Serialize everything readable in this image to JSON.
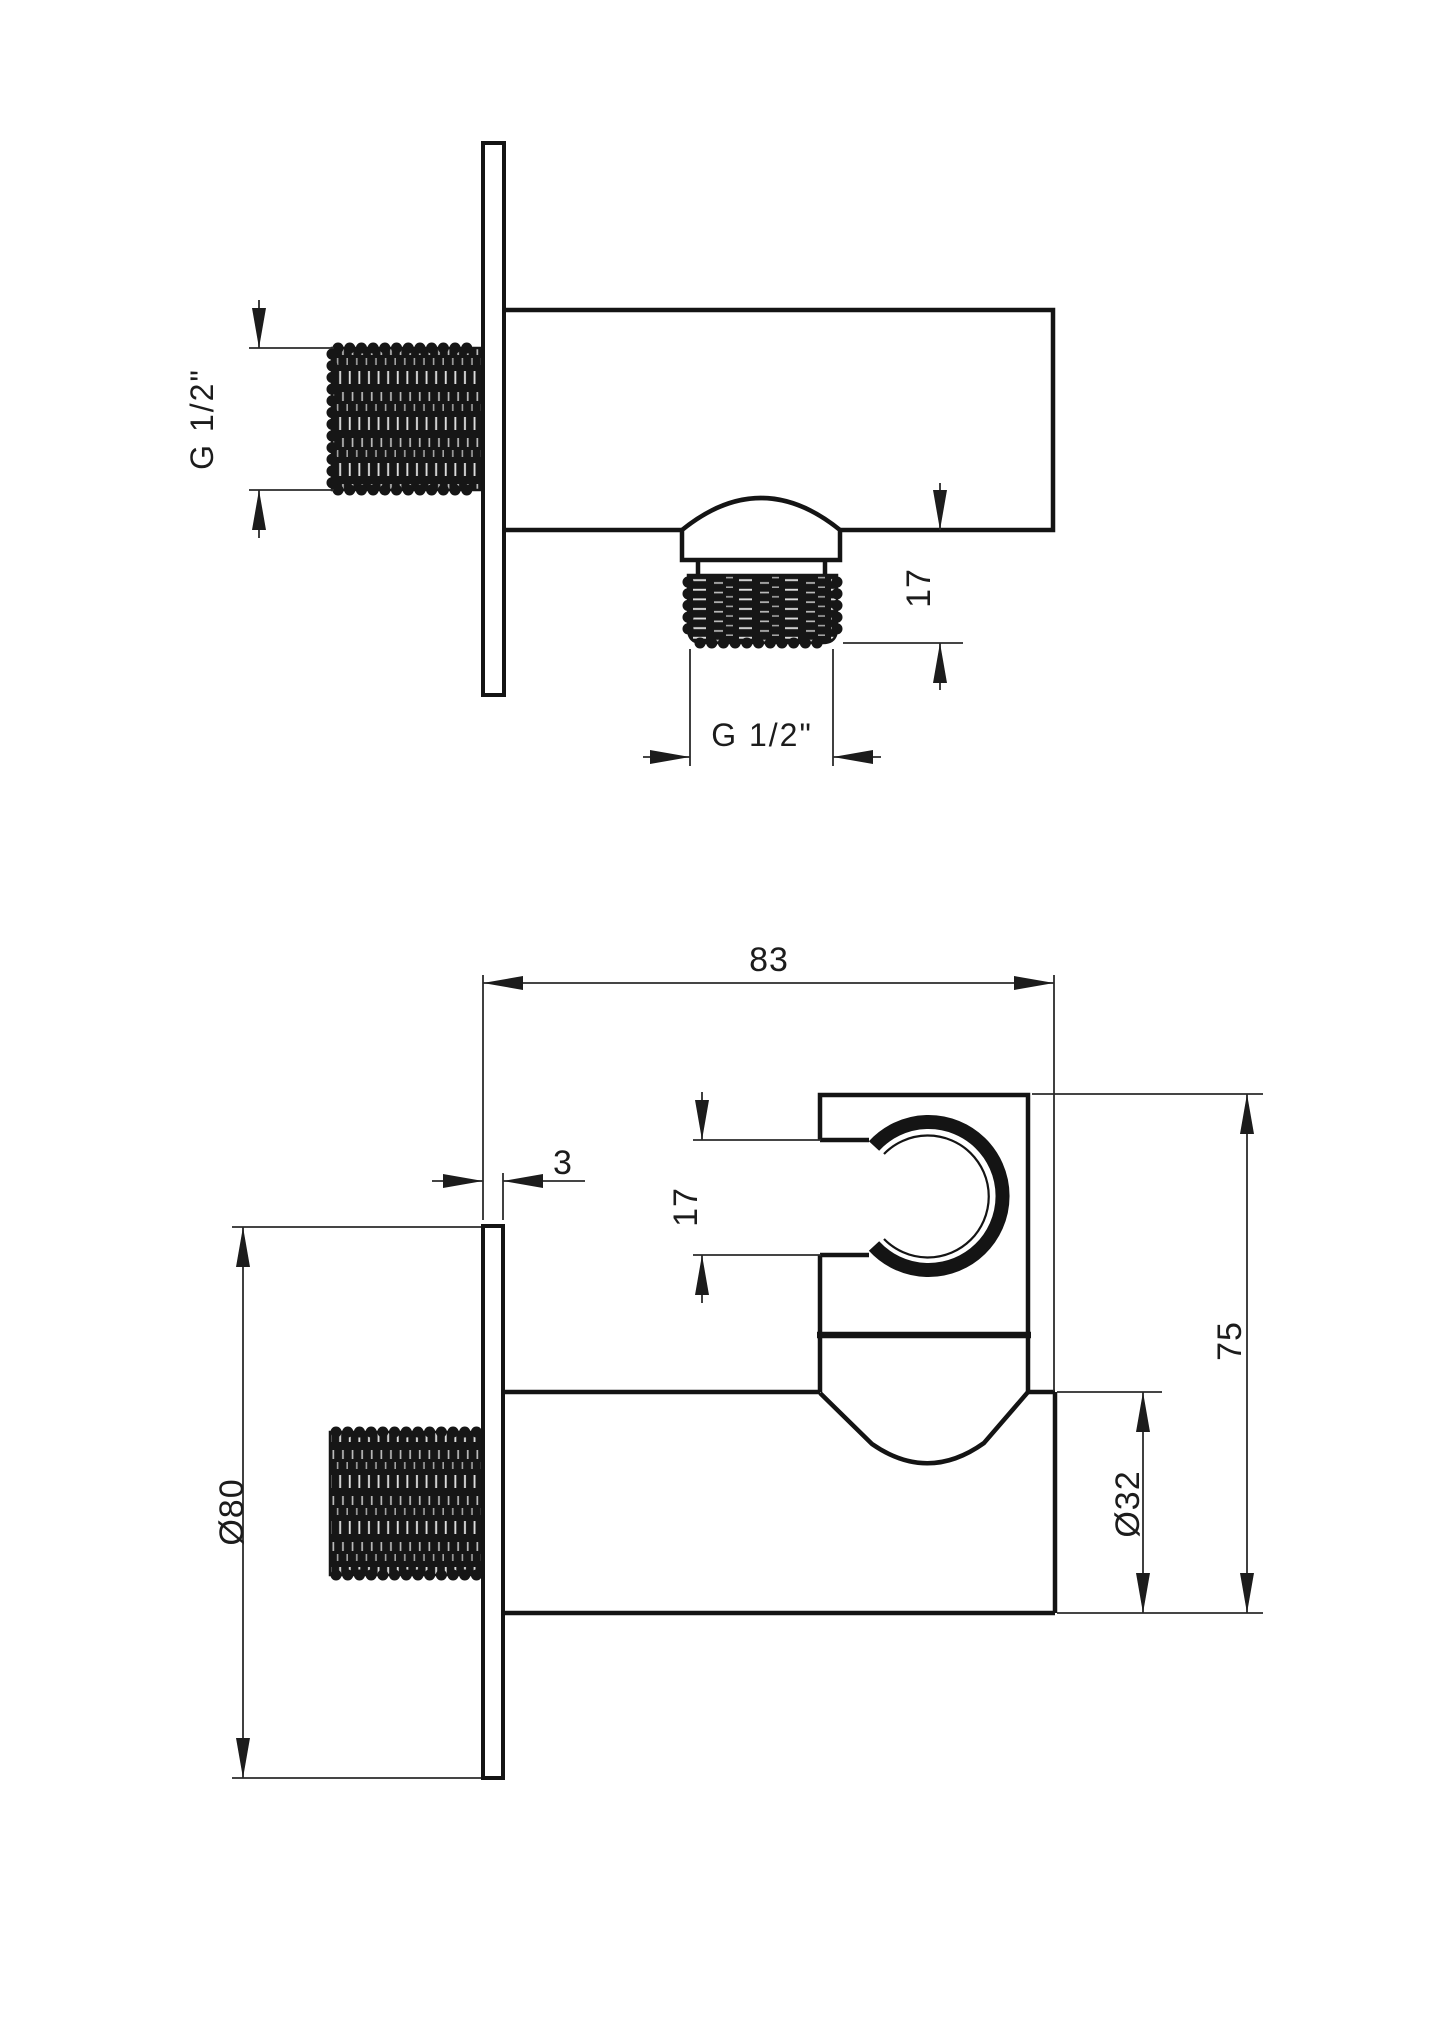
{
  "drawing": {
    "type": "technical-drawing",
    "subject": "wall shower elbow outlet with hand-shower holder",
    "colors": {
      "background": "#ffffff",
      "line": "#1a1a1a"
    },
    "views": {
      "side_view": {
        "name": "side-section-view",
        "dims": {
          "inlet_thread": "G 1/2\"",
          "outlet_thread_length": "17",
          "outlet_thread": "G 1/2\""
        }
      },
      "front_view": {
        "name": "front-elevation-view",
        "dims": {
          "total_depth": "83",
          "plate_thickness": "3",
          "holder_slot": "17",
          "total_height": "75",
          "plate_diameter": "Ø80",
          "body_diameter": "Ø32"
        }
      }
    }
  }
}
